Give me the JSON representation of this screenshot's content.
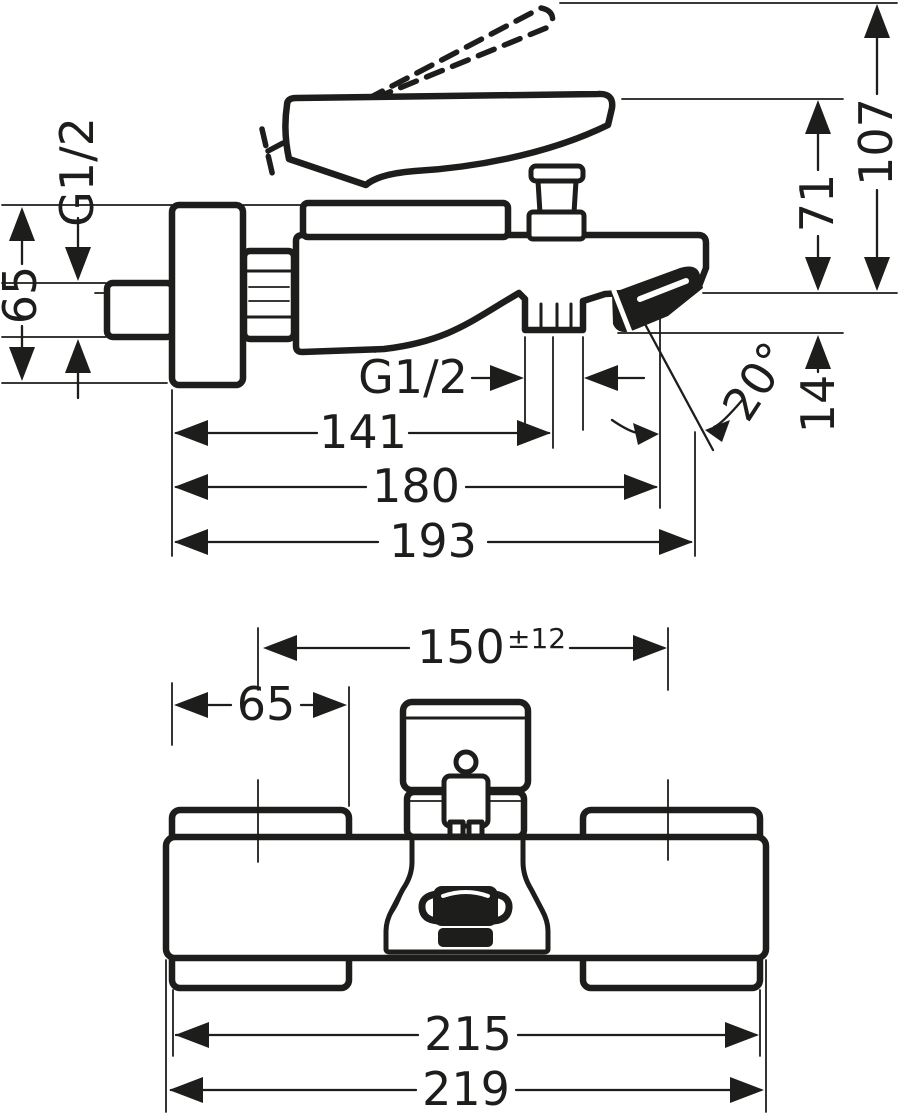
{
  "drawing_colors": {
    "line": "#1d1d1b",
    "background": "#ffffff"
  },
  "side_view": {
    "wall_thread_label": "G1/2",
    "escutcheon_height": "65",
    "outlet_thread_label": "G1/2",
    "dim_wall_to_outlet": "141",
    "dim_wall_to_spout_tip": "180",
    "dim_overall_projection": "193",
    "dim_handle_height": "71",
    "dim_handle_raised_height": "107",
    "dim_aerator_drop": "14",
    "spray_angle": "20°"
  },
  "front_view": {
    "dim_connection_centers": "150",
    "dim_connection_tolerance": "±12",
    "dim_escutcheon_width": "65",
    "dim_body_width": "215",
    "dim_overall_width": "219"
  }
}
